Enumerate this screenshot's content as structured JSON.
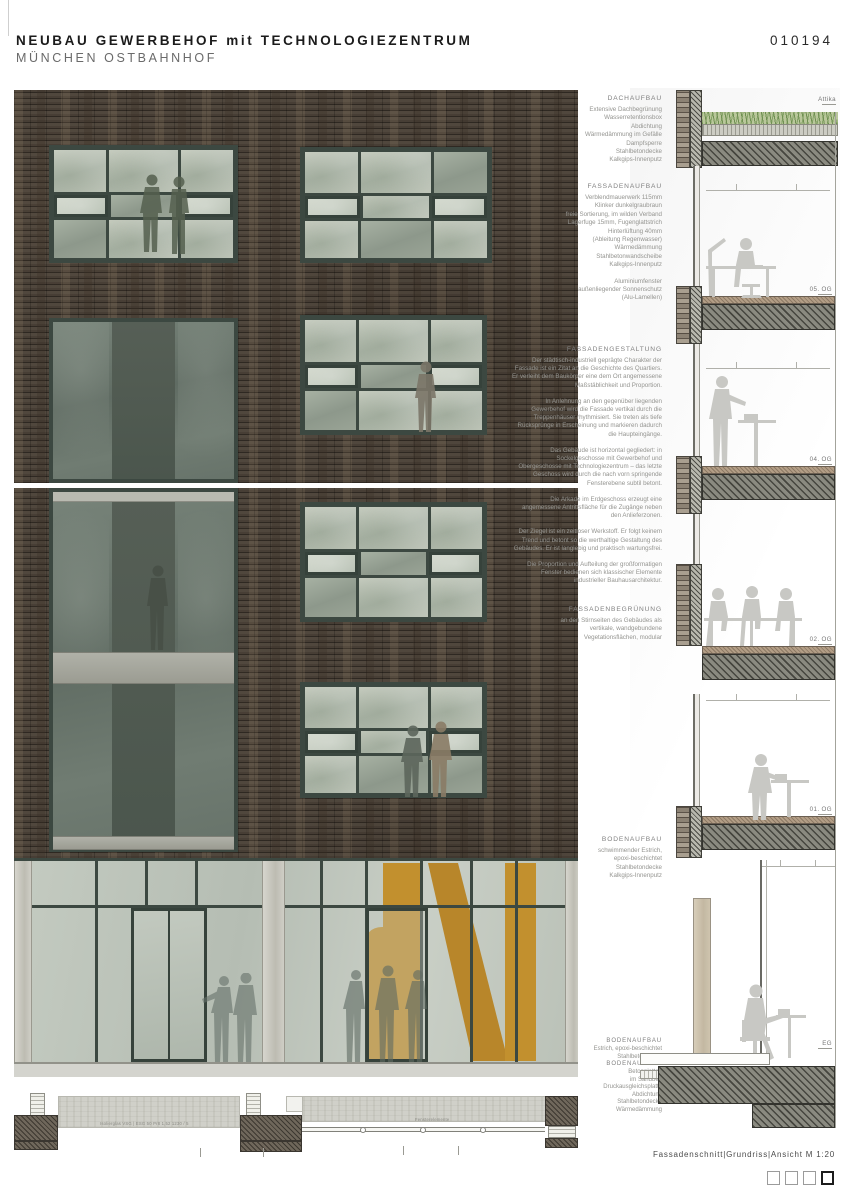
{
  "header": {
    "title": "NEUBAU GEWERBEHOF mit TECHNOLOGIEZENTRUM",
    "subtitle": "MÜNCHEN OSTBAHNHOF",
    "project_number": "010194"
  },
  "annotations": {
    "dachaufbau": {
      "heading": "DACHAUFBAU",
      "lines": [
        "Extensive Dachbegrünung",
        "Wasserretentionsbox",
        "Abdichtung",
        "Wärmedämmung im Gefälle",
        "Dampfsperre",
        "Stahlbetondecke",
        "Kalkgips-Innenputz"
      ]
    },
    "fassadenaufbau": {
      "heading": "FASSADENAUFBAU",
      "lines": [
        "Verblendmauerwerk 115mm",
        "Klinker dunkelgraubraun",
        "freie Sortierung, im wilden Verband",
        "Lagerfuge 15mm, Fugenglattstrich",
        "Hinterlüftung 40mm",
        "(Ableitung Regenwasser)",
        "Wärmedämmung",
        "Stahlbetonwandscheibe",
        "Kalkgips-Innenputz"
      ],
      "extra": [
        "Aluminiumfenster",
        "außenliegender Sonnenschutz",
        "(Alu-Lamellen)"
      ]
    },
    "fassadengestaltung": {
      "heading": "FASSADENGESTALTUNG",
      "paragraphs": [
        "Der städtisch-industriell geprägte Charakter der Fassade ist ein Zitat an die Geschichte des Quartiers. Er verleiht dem Baukörper eine dem Ort angemessene Maßstäblichkeit und Proportion.",
        "In Anlehnung an den gegenüber liegenden Gewerbehof wird die Fassade vertikal durch die Treppenhäuser rhythmisiert. Sie treten als tiefe Rücksprünge in Erscheinung und markieren dadurch die Haupteingänge.",
        "Das Gebäude ist horizontal gegliedert: in Sockelgeschosse mit Gewerbehof und Obergeschosse mit Technologiezentrum – das letzte Geschoss wird durch die nach vorn springende Fensterebene subtil betont.",
        "Die Arkade im Erdgeschoss erzeugt eine angemessene Antrittsfläche für die Zugänge neben den Anlieferzonen.",
        "Der Ziegel ist ein zeitloser Werkstoff. Er folgt keinem Trend und betont so die werthaltige Gestaltung des Gebäudes. Er ist langlebig und praktisch wartungsfrei.",
        "Die Proportion und Aufteilung der großformatigen Fenster bedienen sich klassischer Elemente industrieller Bauhausarchitektur."
      ]
    },
    "fassadenbegruenung": {
      "heading": "FASSADENBEGRÜNUNG",
      "lines": [
        "an den Stirnseiten des Gebäudes als",
        "vertikale, wandgebundene",
        "Vegetationsflächen, modular"
      ]
    },
    "bodenaufbau_og": {
      "heading": "BODENAUFBAU",
      "lines": [
        "schwimmender Estrich,",
        "epoxi-beschichtet",
        "Stahlbetondecke",
        "Kalkgips-Innenputz"
      ]
    },
    "bodenaufbau_eg": {
      "heading": "BODENAUFBAU",
      "lines": [
        "Estrich, epoxi-beschichtet",
        "Stahlbetondecke"
      ]
    },
    "bodenaufbau_aussen": {
      "heading": "BODENAUFBAU",
      "lines": [
        "Betonplatten",
        "im Sandbett",
        "Druckausgleichsplatte",
        "Abdichtung",
        "Stahlbetondecke",
        "Wärmedämmung"
      ]
    }
  },
  "section": {
    "attika_label": "Attika",
    "floor_labels": [
      "05. OG",
      "04. OG",
      "02. OG",
      "01. OG",
      "EG"
    ]
  },
  "details": {
    "left_label": "Isolierglas VSG | ESG 50 Pr8 1,52 1230 / 5",
    "right_label": "Fensterelemente"
  },
  "footer": {
    "caption": "Fassadenschnitt|Grundriss|Ansicht  M 1:20"
  },
  "colors": {
    "frame": "#3c4841",
    "brick": "#473e35",
    "glass": "#b7bfb2",
    "orange": "#c2902e",
    "concrete": "#d0d0c9",
    "silhouette": "#c8c8c4",
    "annotation_gray": "#949490"
  }
}
